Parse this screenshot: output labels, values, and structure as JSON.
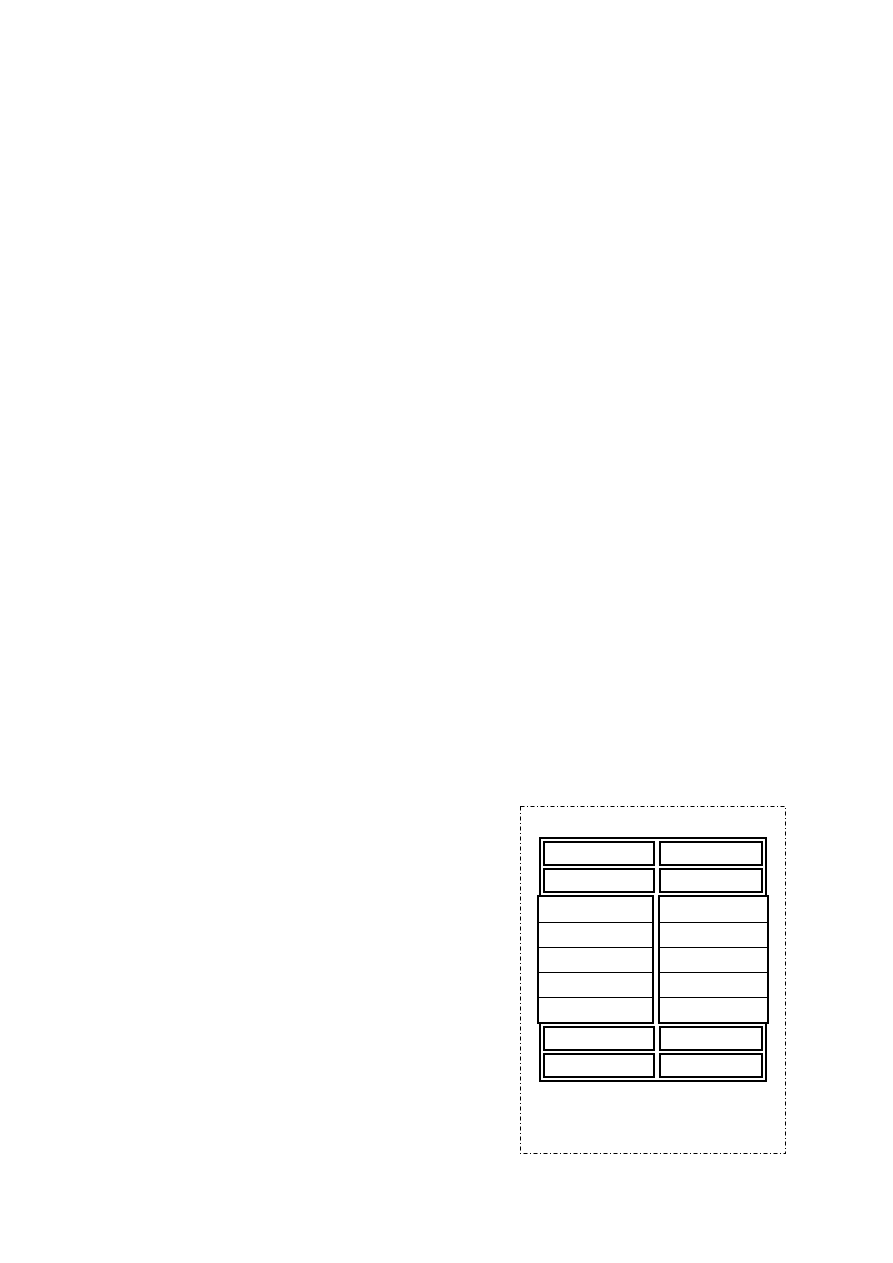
{
  "page": {
    "background": "#ffffff",
    "line_color": "#000000"
  },
  "figure_box": {
    "border_style": "dash-dot",
    "dash_pattern": "4 2.5 1 2.5"
  },
  "table": {
    "columns": 2,
    "all_cells_empty": true,
    "sections": [
      {
        "type": "row",
        "cells": [
          "",
          ""
        ]
      },
      {
        "type": "row",
        "cells": [
          "",
          ""
        ]
      },
      {
        "type": "group",
        "sub_rows": 5,
        "cells": [
          [
            "",
            "",
            "",
            "",
            ""
          ],
          [
            "",
            "",
            "",
            "",
            ""
          ]
        ]
      },
      {
        "type": "row",
        "cells": [
          "",
          ""
        ]
      },
      {
        "type": "row",
        "cells": [
          "",
          ""
        ]
      }
    ]
  }
}
